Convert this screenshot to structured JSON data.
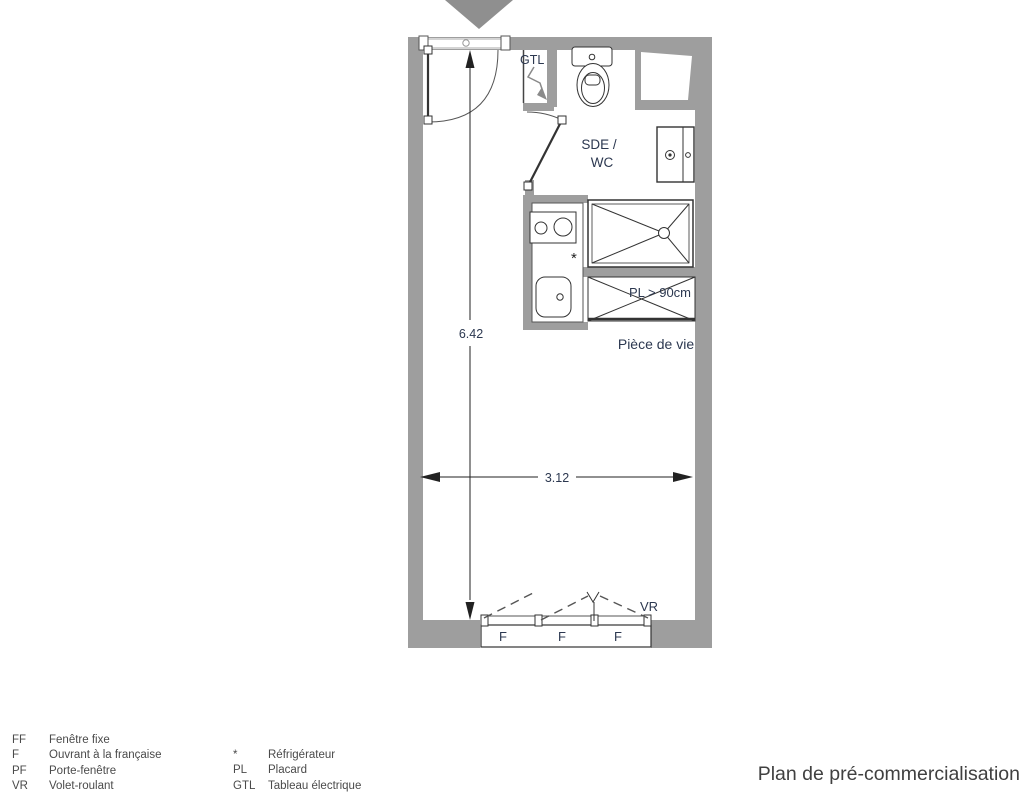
{
  "colors": {
    "wall": "#9e9e9e",
    "plan_label": "#2c3850",
    "drawing_line": "#333333",
    "legend_text": "#4a4a4a",
    "title_text": "#404040"
  },
  "plan": {
    "labels": {
      "gtl": "GTL",
      "sde_line1": "SDE /",
      "sde_line2": "WC",
      "placard": "PL > 90cm",
      "living": "Pièce de vie",
      "vr": "VR",
      "fridge_marker": "*"
    },
    "dimensions": {
      "height_m": "6.42",
      "width_m": "3.12"
    },
    "windows": [
      "F",
      "F",
      "F"
    ]
  },
  "legend": {
    "left": [
      {
        "abbr": "FF",
        "label": "Fenêtre fixe"
      },
      {
        "abbr": "F",
        "label": "Ouvrant à la française"
      },
      {
        "abbr": "PF",
        "label": "Porte-fenêtre"
      },
      {
        "abbr": "VR",
        "label": "Volet-roulant"
      }
    ],
    "right": [
      {
        "abbr": "*",
        "label": "Réfrigérateur"
      },
      {
        "abbr": "PL",
        "label": "Placard"
      },
      {
        "abbr": "GTL",
        "label": "Tableau électrique"
      }
    ]
  },
  "footer": {
    "title": "Plan de pré-commercialisation"
  }
}
